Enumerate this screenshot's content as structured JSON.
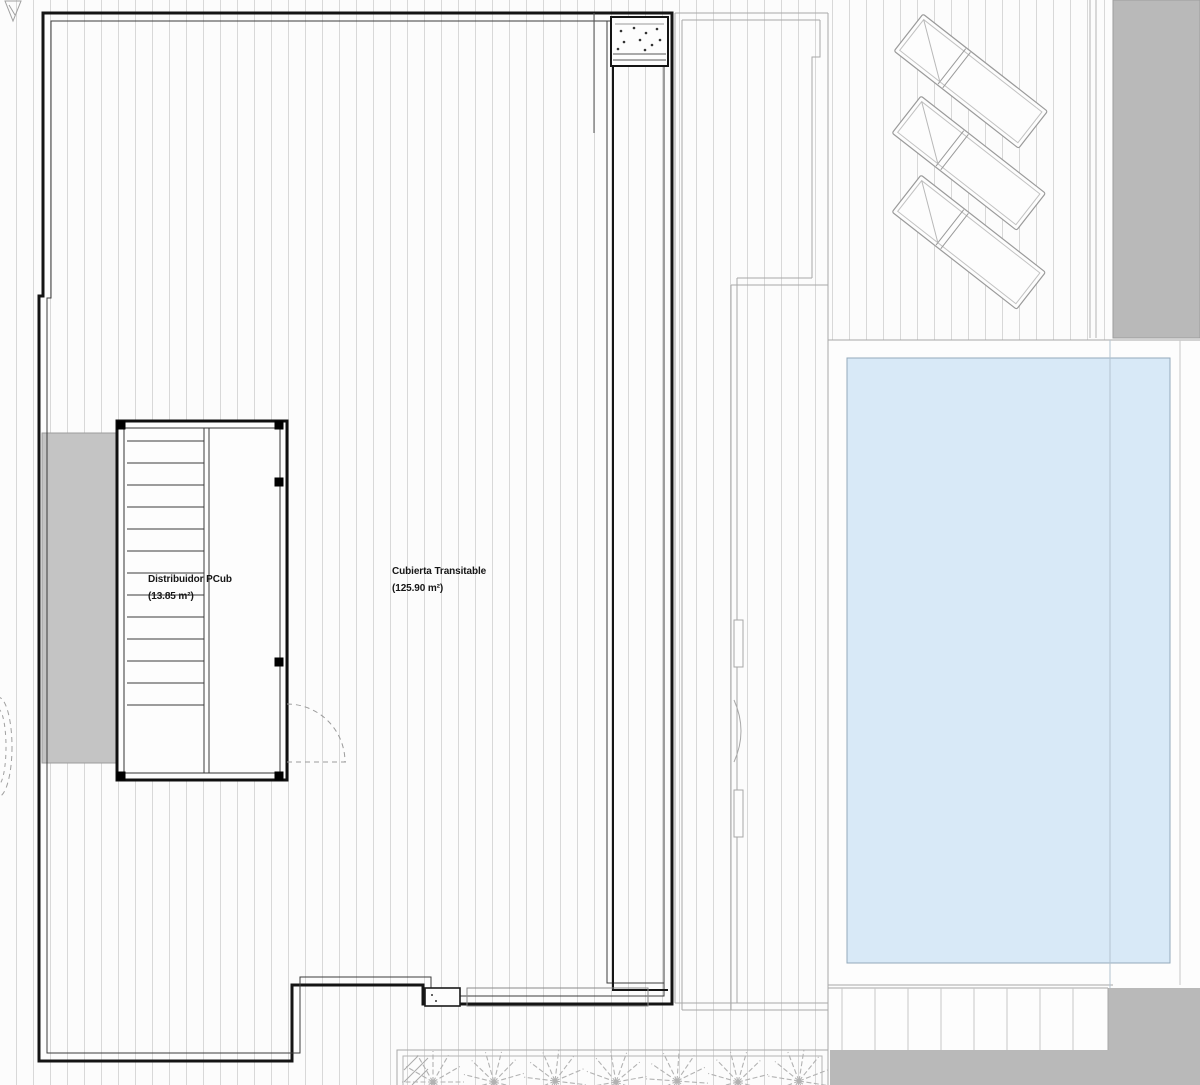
{
  "labels": {
    "distribuidor": {
      "line1": "Distribuidor PCub",
      "line2": "(13.85 m²)"
    },
    "cubierta": {
      "line1": "Cubierta Transitable",
      "line2": "(125.90 m²)"
    }
  },
  "features": {
    "sun_lounger_count": 3,
    "palm_plant_count": 7,
    "stair_tread_count": 13
  },
  "colors": {
    "pool_fill": "#d8e9f7",
    "pool_border": "#93a9bb",
    "gray_band": "#b9b9b9",
    "gray_block": "#c4c4c4",
    "decking_line": "#d8d8d8",
    "outline_dark": "#141414",
    "outline_light": "#a8a8a8"
  }
}
